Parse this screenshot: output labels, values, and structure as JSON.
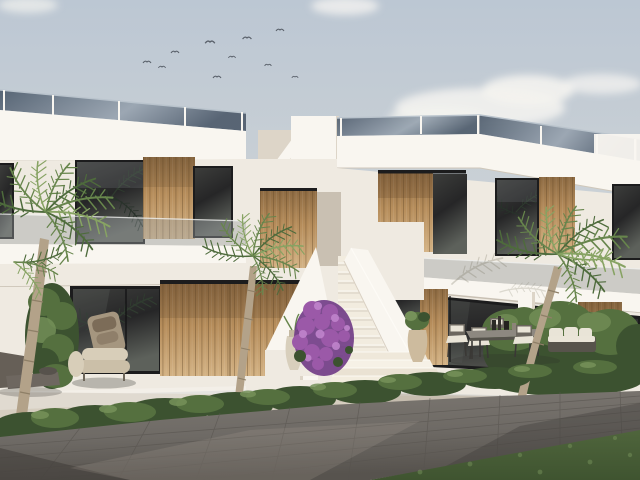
{
  "scene": {
    "alt": "3D architectural render of a modern white two-storey Mediterranean apartment building with wooden slat doors, glass balustrades, an external white staircase with purple bougainvillea, palm trees, green hedges, outdoor lounge and dining furniture, and a grey paved walkway in the foreground under a pale sky with a flock of birds.",
    "type": "architectural-3d-render",
    "time_of_day": "day",
    "sky": {
      "birds": 10,
      "clouds": 3
    },
    "objects": [
      "flat-roof white building",
      "roof glass balustrade",
      "upper-floor windows",
      "wooden slat panels",
      "balcony with glass railing",
      "external staircase",
      "roof staircase",
      "bougainvillea shrub",
      "palm trees",
      "hedges",
      "lounge chair",
      "shaded sun lounger",
      "outdoor dining table with chairs",
      "outdoor sofa",
      "decorative vases",
      "planted border",
      "paved walkway",
      "lawn"
    ],
    "counts": {
      "palm_trees": 3,
      "dining_chairs": 5,
      "stair_steps": 12
    }
  },
  "palette": {
    "sky_top": "#bcc7d3",
    "sky_mid": "#ccd2d6",
    "sky_low": "#e6e0d6",
    "cloud": "#f4f3f0",
    "bird": "#59606a",
    "wall_bright": "#f9f6f0",
    "wall_white": "#efeae1",
    "wall_shade": "#ddd5c8",
    "wall_dark": "#c9c0b2",
    "rail_dark": "#4e5c6c",
    "rail_light": "#98a4b0",
    "rail_line": "#b9c3cc",
    "win_dark": "#262627",
    "win_mid": "#3c3d3b",
    "win_light": "#5d615b",
    "frame": "#1c1c1d",
    "wood_light": "#d3b284",
    "wood_mid": "#b68d5b",
    "wood_dark": "#8d6a42",
    "wood_deep": "#6e5233",
    "hedge_dark": "#3c5230",
    "hedge_mid": "#55703f",
    "hedge_light": "#76925a",
    "palm_dark": "#4e6b3c",
    "palm_mid": "#67854c",
    "palm_light": "#87a363",
    "trunk": "#b3a289",
    "trunk_dark": "#8e7f67",
    "bougain": "#9b59a8",
    "bougain_dark": "#6f3a85",
    "bougain_light": "#c084cc",
    "terrace": "#d6cec0",
    "terrace_shade": "#b5ac9d",
    "pave": "#6e6a65",
    "pave_light": "#7d7872",
    "pave_dark": "#57534e",
    "pave_shadow": "#403c39",
    "lawn": "#4f653c",
    "lawn_dark": "#3f5430",
    "cushion": "#e9e4d7",
    "chair_frame": "#6b665e",
    "chair_leg": "#3a3835",
    "table_top": "#8d8880",
    "lounge_a": "#cbbfa8",
    "lounge_b": "#d8ceb9",
    "lounge_back": "#a5967f",
    "pillow": "#7c6c58",
    "vase": "#d8cfbc"
  }
}
